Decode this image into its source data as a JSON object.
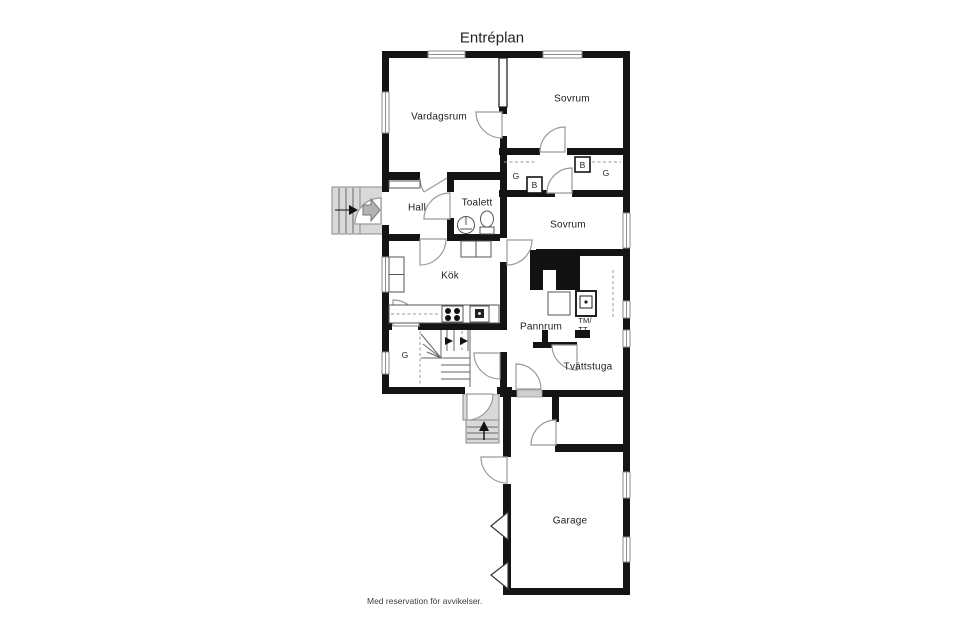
{
  "title": "Entréplan",
  "caption": "Med reservation för avvikelser.",
  "rooms": {
    "vardagsrum": "Vardagsrum",
    "sovrum1": "Sovrum",
    "hall": "Hall",
    "toalett": "Toalett",
    "sovrum2": "Sovrum",
    "kok": "Kök",
    "pannrum": "Pannrum",
    "tvattstuga": "Tvättstuga",
    "garage": "Garage"
  },
  "closets": {
    "g1": "G",
    "b1": "B",
    "b2": "B",
    "g2": "G",
    "g3": "G"
  },
  "labels": {
    "tm": "TM/",
    "tt": "TT"
  },
  "colors": {
    "wall": "#141414",
    "door_arc": "#9a9a9a",
    "exterior_step": "#d9d9d9",
    "window_line": "#8c8c8c",
    "floor": "#ffffff"
  }
}
